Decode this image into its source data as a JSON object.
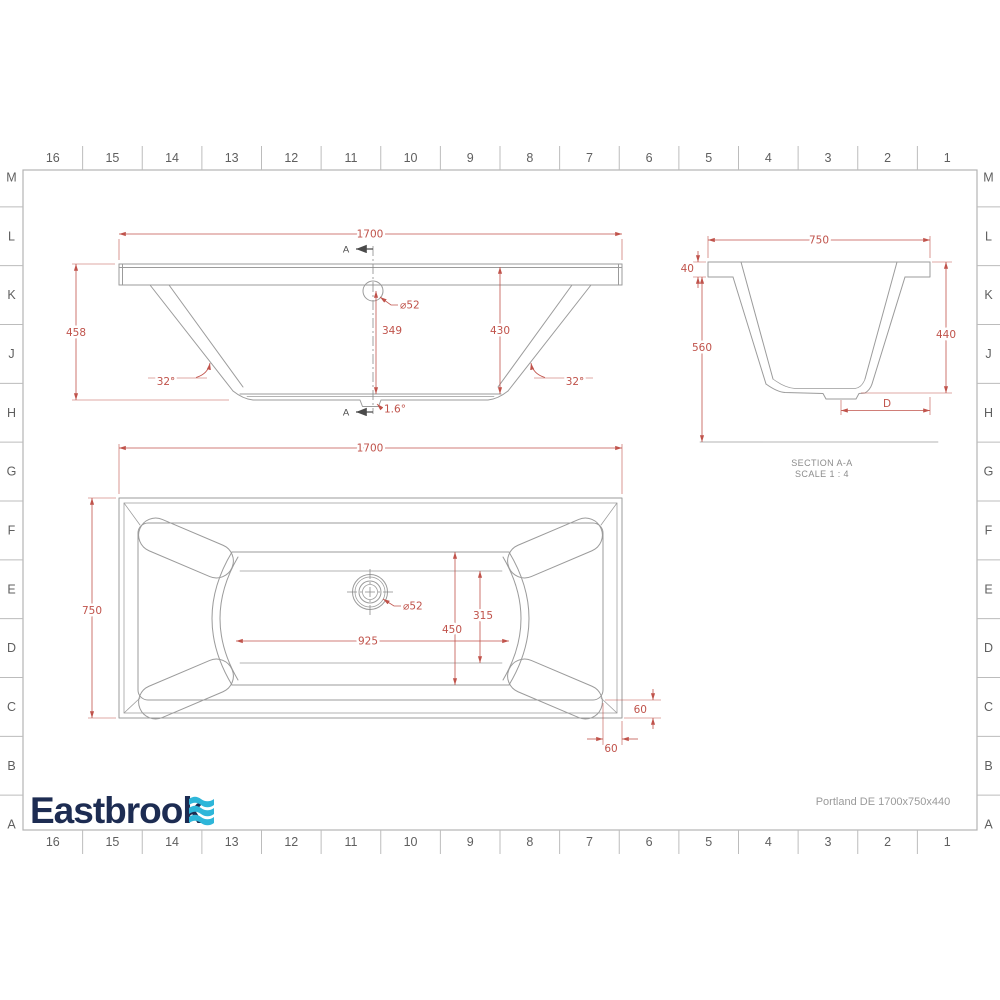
{
  "colors": {
    "dimension": "#c0534b",
    "line": "#9b9b9b",
    "marker": "#4a4a4a",
    "grid_text": "#5f5f5f",
    "note_text": "#8c8c8c",
    "logo_navy": "#1d2c52",
    "logo_wave": "#2eb6d9"
  },
  "grid": {
    "column_labels": [
      "16",
      "15",
      "14",
      "13",
      "12",
      "11",
      "10",
      "9",
      "8",
      "7",
      "6",
      "5",
      "4",
      "3",
      "2",
      "1"
    ],
    "row_labels": [
      "M",
      "L",
      "K",
      "J",
      "H",
      "G",
      "F",
      "E",
      "D",
      "C",
      "B",
      "A"
    ]
  },
  "front_view": {
    "section_marker": "A",
    "dims": {
      "width": "1700",
      "overall_height": "458",
      "inner_height": "430",
      "overflow_height": "349",
      "overflow_dia": "⌀52",
      "angle_left": "32°",
      "angle_right": "32°",
      "floor_slope": "1.6°"
    }
  },
  "section_view": {
    "title": "SECTION A-A",
    "scale": "SCALE 1 : 4",
    "dims": {
      "width": "750",
      "rim_thickness": "40",
      "overall_height": "560",
      "inner_depth": "440",
      "waste_offset": "D"
    }
  },
  "plan_view": {
    "dims": {
      "length": "1700",
      "width": "750",
      "floor_length": "925",
      "floor_width": "450",
      "waste_position": "315",
      "waste_dia": "⌀52",
      "corner_offset_v": "60",
      "corner_offset_h": "60"
    }
  },
  "footer": {
    "logo_text": "Eastbrook",
    "product": "Portland DE 1700x750x440"
  }
}
